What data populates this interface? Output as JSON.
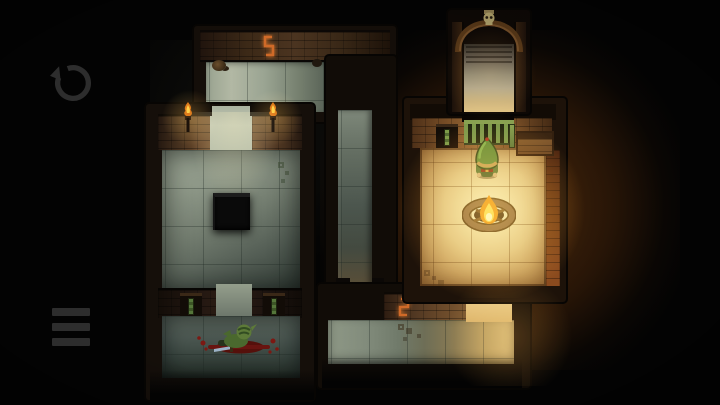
{
  "app": {
    "name": "top-down pixel dungeon puzzle game",
    "scene": "dungeon level: two cool-lit western rooms and corridors connect to a warm campfire room in the east"
  },
  "hud": {
    "undo_button": {
      "icon": "undo-arrow-icon",
      "title": "Undo / Restart"
    },
    "menu_button": {
      "icon": "hamburger-menu-icon",
      "title": "Menu"
    }
  },
  "level": {
    "player": {
      "name": "hero",
      "desc": "green-hooded character standing at campfire, facing south",
      "room": "campfire-room"
    },
    "objects": [
      {
        "name": "campfire",
        "room": "campfire-room",
        "desc": "stone ring with burning flame"
      },
      {
        "name": "green-gate",
        "room": "campfire-room",
        "position": "north doorway"
      },
      {
        "name": "wooden-crate",
        "room": "campfire-room",
        "position": "north wall east side"
      },
      {
        "name": "green-banners",
        "room": "campfire-room",
        "position": "west wall"
      },
      {
        "name": "skull-arch",
        "position": "north entrance archway"
      },
      {
        "name": "stairs",
        "position": "north entrance"
      },
      {
        "name": "wall-torch",
        "count": 2,
        "room": "west-room",
        "state": "lit"
      },
      {
        "name": "floor-pit",
        "room": "west-room",
        "desc": "dark square hole in floor"
      },
      {
        "name": "green-banners",
        "count": 2,
        "room": "southwest-room"
      },
      {
        "name": "goblin-corpse",
        "room": "southwest-room",
        "desc": "slain goblin, blood spatter, dropped sword"
      },
      {
        "name": "wall-rune",
        "count": 2,
        "desc": "glowing orange rune markers on corridor walls"
      },
      {
        "name": "debris",
        "room": "north-corridor"
      }
    ]
  },
  "colors": {
    "bg": "#030303",
    "ui_icon": "#2d2d2d",
    "flame_yellow": "#ffd24a",
    "flame_orange": "#e07c1c",
    "rune_orange": "#d06a28",
    "green_bright": "#7fa04a",
    "green_mid": "#55763a",
    "green_dark": "#2c3d20",
    "blood_red": "#7c1812",
    "blood_dark": "#55100b",
    "skull_bone": "#a89a66",
    "sword_steel": "#9cb2c6",
    "floor_cool": "#8e9888",
    "floor_warm": "#e2c27e",
    "wall_brick_lit": "#6b4a2c",
    "wall_warm_lit": "#9a6a38",
    "halo_warm": "#96501a"
  }
}
